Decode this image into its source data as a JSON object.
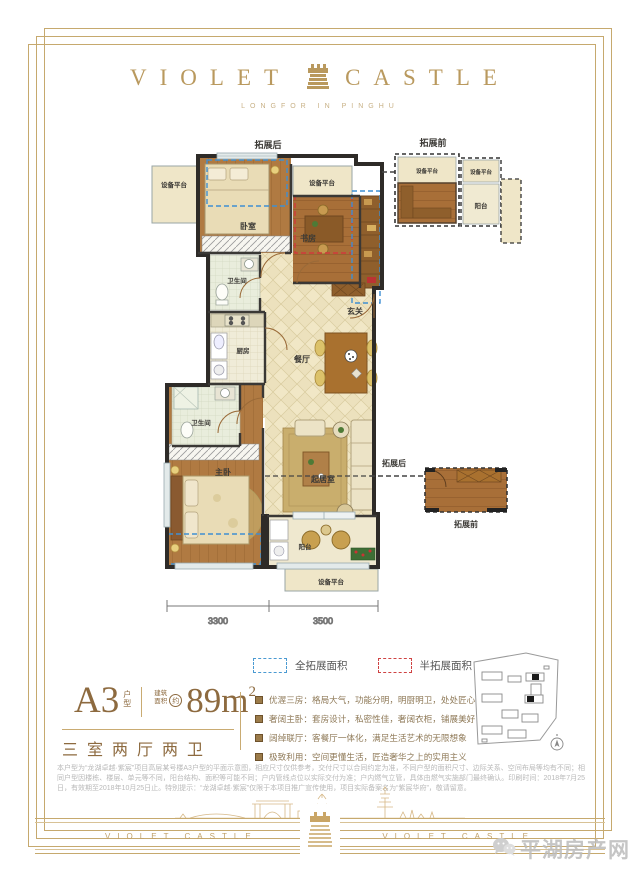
{
  "header": {
    "title_left": "VIOLET",
    "title_right": "CASTLE",
    "subtitle": "LONGFOR IN PINGHU"
  },
  "floorplan": {
    "labels": {
      "expand_after": "拓展后",
      "expand_before": "拓展前",
      "equipment": "设备平台",
      "bedroom": "卧室",
      "study": "书房",
      "bath": "卫生间",
      "kitchen": "厨房",
      "foyer": "玄关",
      "dining": "餐厅",
      "master": "主卧",
      "living": "起居室",
      "balcony": "阳台"
    },
    "dimensions": {
      "left": "3300",
      "right": "3500"
    }
  },
  "legend": {
    "full": {
      "label": "全拓展面积",
      "color": "#4a9ad2"
    },
    "half": {
      "label": "半拓展面积",
      "color": "#cf4343"
    }
  },
  "info": {
    "unit": "A3",
    "unit_type_top": "户",
    "unit_type_bottom": "型",
    "area_prefix_top": "建筑",
    "area_prefix_bottom": "面积",
    "area_approx": "约",
    "area_value": "89m",
    "area_exponent": "2",
    "layout": "三室两厅两卫"
  },
  "features": [
    "优渥三房：格局大气，功能分明，明厨明卫，处处匠心",
    "奢阔主卧：套房设计，私密性佳，奢阔衣柜，铺展美好",
    "阔绰联厅：客餐厅一体化，满足生活艺术的无限想象",
    "极致利用：空间更懂生活，匠造奢华之上的实用主义"
  ],
  "disclaimer": "本户型为“龙湖卓越·紫宸”项目高层某号楼A3户型的平面示意图，相应尺寸仅供参考，交付尺寸以合同约定为准，不同户型的面积尺寸、边际关系、空间布局等均有不同；相同户型因楼栋、楼层、单元等不同，阳台结构、面积等可能不同；户内管线点位以实际交付为准；户内燃气立管，具体由燃气实施部门最终确认。印刷时间：2018年7月25日，有效期至2018年10月25日止。特别提示：“龙湖卓越·紫宸”仅限于本项目推广宣传使用，项目实际备案名为“紫宸华府”，敬请留意。",
  "footer": {
    "brand_left": "VIOLET CASTLE",
    "brand_right": "VIOLET CASTLE"
  },
  "watermark": {
    "name": "平湖房产网"
  }
}
